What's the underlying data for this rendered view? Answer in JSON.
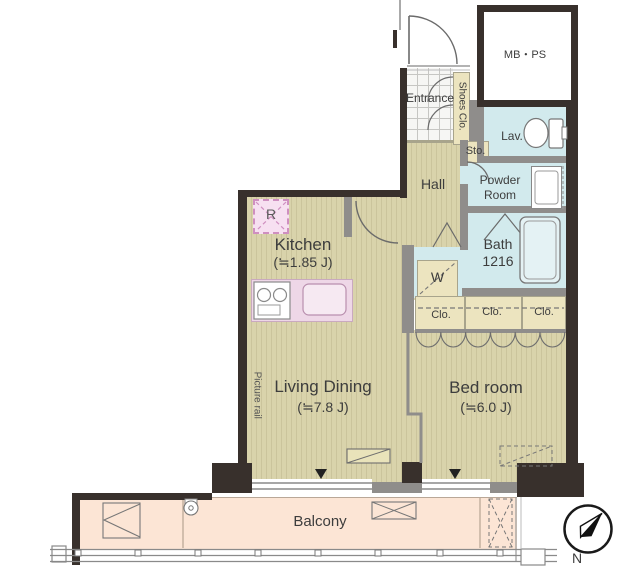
{
  "title": "1LDK apartment floor plan",
  "rooms": {
    "mbps": {
      "label": "MB・PS"
    },
    "entrance": {
      "label": "Entrance"
    },
    "shoes_closet": {
      "label": "Shoes Clo."
    },
    "storage": {
      "label": "Sto."
    },
    "lavatory": {
      "label": "Lav."
    },
    "powder_room": {
      "line1": "Powder",
      "line2": "Room"
    },
    "hall": {
      "label": "Hall"
    },
    "bath": {
      "line1": "Bath",
      "line2": "1216"
    },
    "washer": {
      "label": "W"
    },
    "closets": [
      "Clo.",
      "Clo.",
      "Clo."
    ],
    "kitchen": {
      "label": "Kitchen",
      "size": "(≒1.85 J)"
    },
    "living_dining": {
      "label": "Living Dining",
      "size": "(≒7.8 J)"
    },
    "bedroom": {
      "label": "Bed room",
      "size": "(≒6.0 J)"
    },
    "balcony": {
      "label": "Balcony"
    },
    "refrigerator": {
      "label": "R"
    },
    "picture_rail": {
      "label": "Picture rail"
    },
    "compass": {
      "label": "N"
    }
  },
  "icons": {
    "toilet": "ellipse-with-tank",
    "bathtub": "rounded-rect",
    "vanity": "rect-with-basin",
    "stove": "two-burner-circles",
    "sink": "rounded-rect",
    "compass": "circle-with-ne-needle",
    "window_marker": "down-triangle",
    "closet_curtain": "scallops"
  },
  "colors": {
    "wall_dark": "#38302c",
    "wall_gray": "#8f8d8b",
    "floor_tan": "#d9d3ab",
    "wet_blue": "#d2eaed",
    "closet_cream": "#ece4bf",
    "balcony_peach": "#fce5d5",
    "kitchen_pink": "#eed7e7"
  }
}
